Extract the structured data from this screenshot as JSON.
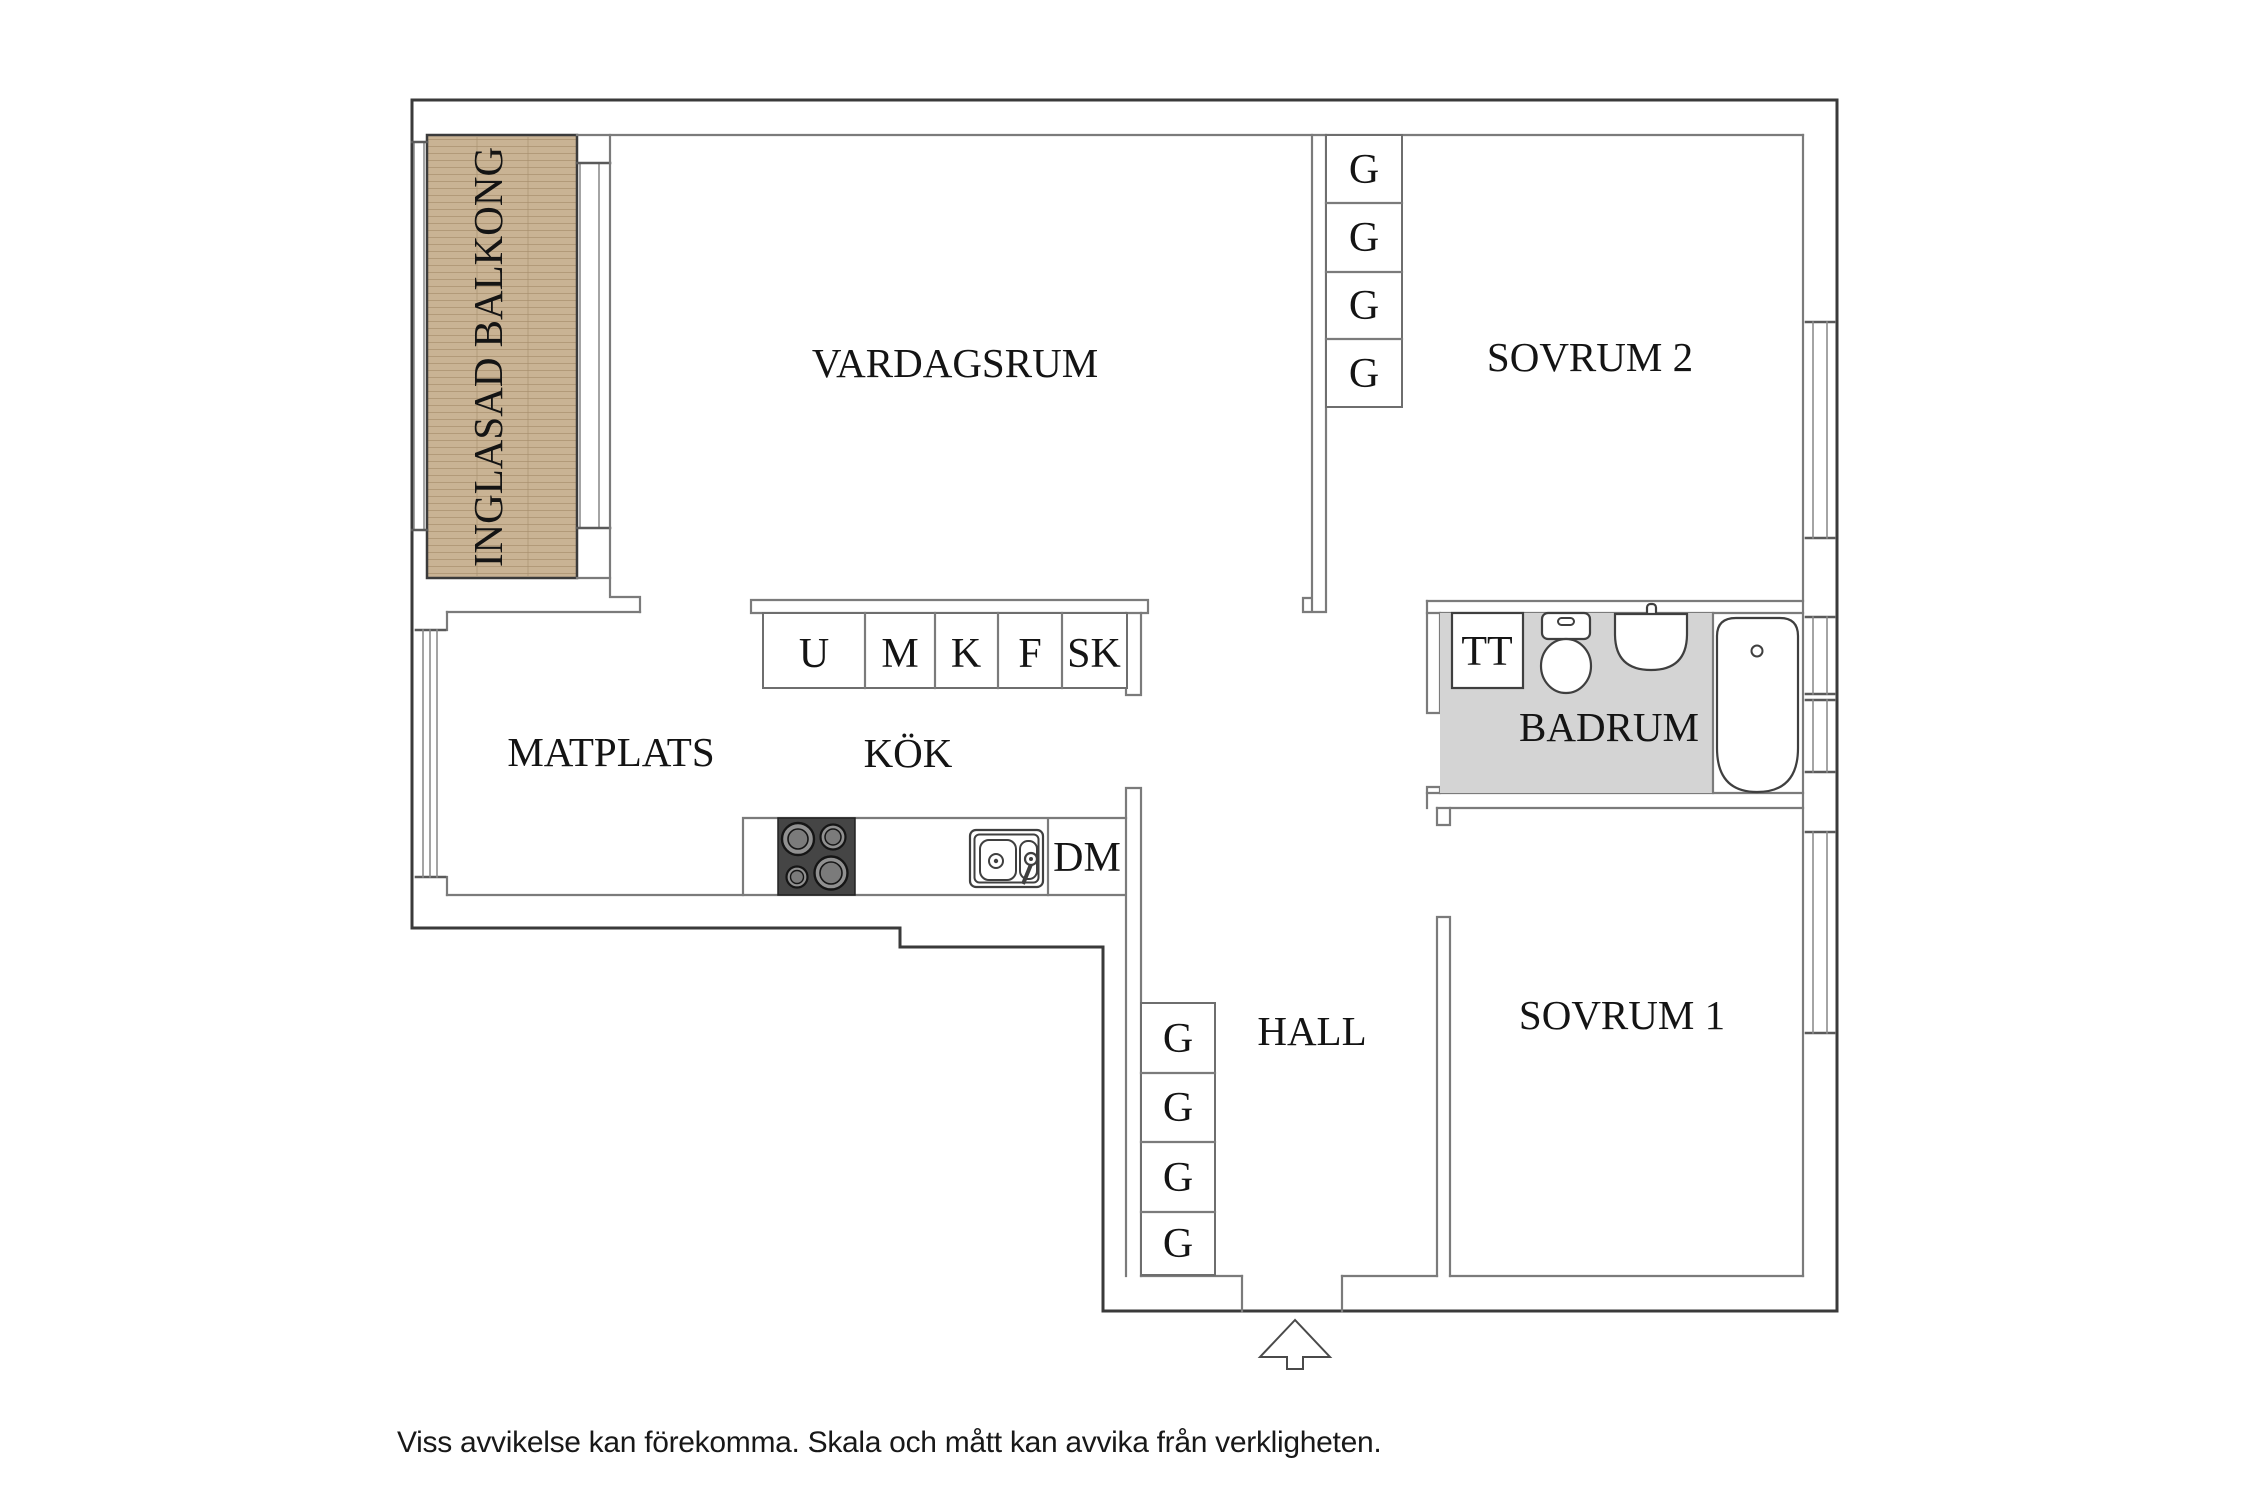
{
  "rooms": {
    "balcony": "INGLASAD BALKONG",
    "living_room": "VARDAGSRUM",
    "bedroom2": "SOVRUM 2",
    "dining": "MATPLATS",
    "kitchen": "KÖK",
    "bathroom": "BADRUM",
    "hall": "HALL",
    "bedroom1": "SOVRUM 1"
  },
  "symbols": {
    "dryer": "TT",
    "dishwasher": "DM",
    "cabinets": [
      "U",
      "M",
      "K",
      "F",
      "SK"
    ],
    "wardrobes_bedroom2": [
      "G",
      "G",
      "G",
      "G"
    ],
    "wardrobes_hall": [
      "G",
      "G",
      "G",
      "G"
    ]
  },
  "footer": {
    "disclaimer": "Viss avvikelse kan förekomma. Skala och mått kan avvika från verkligheten."
  },
  "colors": {
    "balcony_wood": "#c9b394",
    "balcony_grain": "#b09674",
    "bathroom_floor": "#d4d4d4",
    "stove": "#454545"
  }
}
